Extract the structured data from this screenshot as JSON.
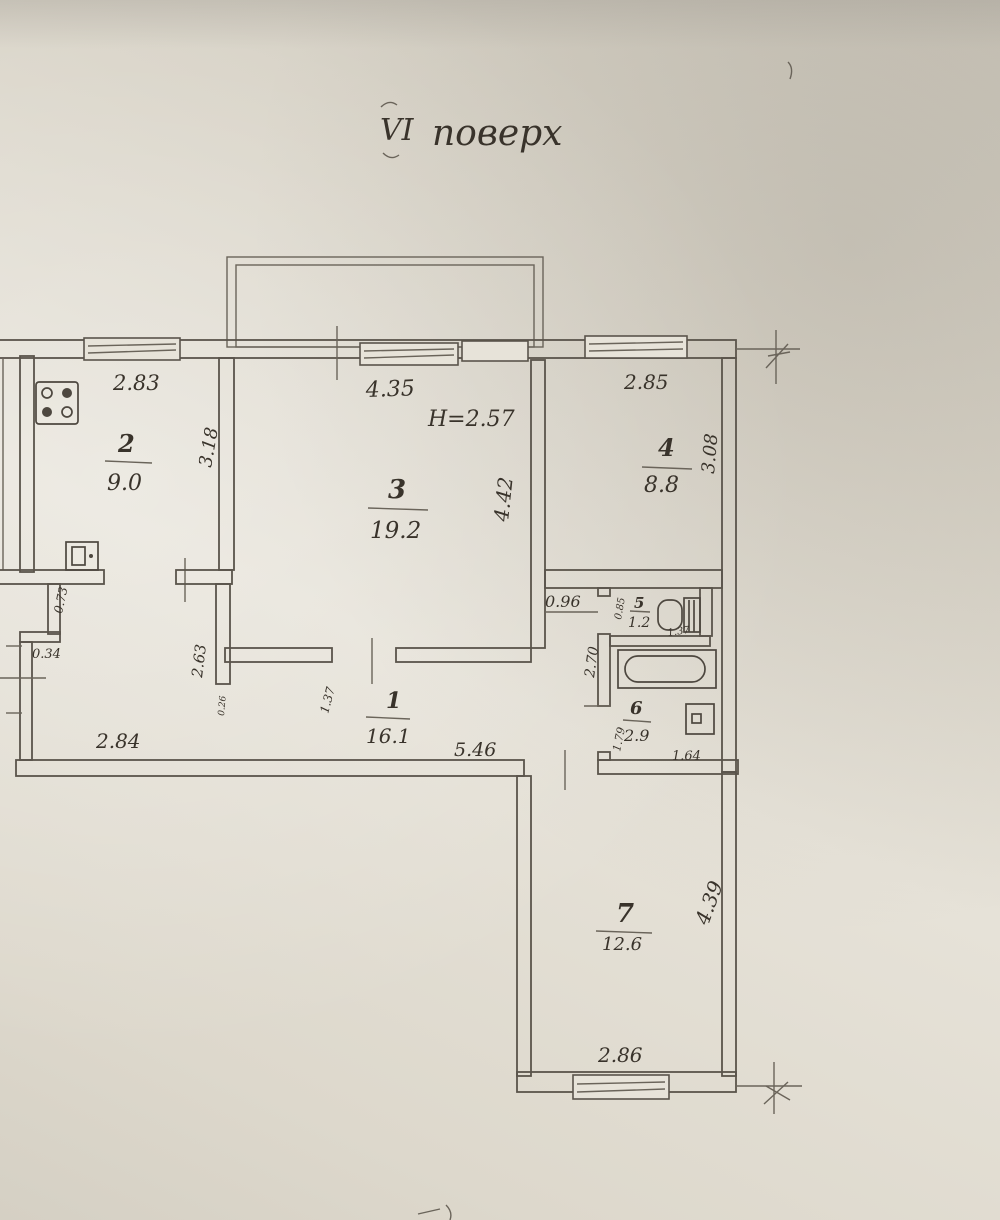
{
  "document": {
    "type": "apartment floor plan (hand-drawn BTI sketch)",
    "floor_title": {
      "roman": "VI",
      "word": "поверх"
    },
    "ceiling_height_note": "H=2.57"
  },
  "rooms": {
    "r1": {
      "number": "1",
      "area": "16.1"
    },
    "r2": {
      "number": "2",
      "area": "9.0"
    },
    "r3": {
      "number": "3",
      "area": "19.2"
    },
    "r4": {
      "number": "4",
      "area": "8.8"
    },
    "r5": {
      "number": "5",
      "area": "1.2"
    },
    "r6": {
      "number": "6",
      "area": "2.9"
    },
    "r7": {
      "number": "7",
      "area": "12.6"
    }
  },
  "dims": {
    "r2_width": "2.83",
    "r2_depth": "3.18",
    "r3_width": "4.35",
    "r3_depth": "4.42",
    "r4_width": "2.85",
    "r4_depth": "3.08",
    "niche_width": "0.96",
    "r5_width": "0.85",
    "r5_depth": "1.37",
    "r6_outer_depth": "2.70",
    "r6_inner_depth": "1.79",
    "r6_width": "1.64",
    "r1_pass_width": "1.37",
    "r1_length": "5.46",
    "alcove_niche_depth": "0.73",
    "alcove_step": "0.34",
    "alcove_width": "2.84",
    "alcove_depth": "2.63",
    "wall_thickness": "0.26",
    "r7_depth": "4.39",
    "r7_width": "2.86"
  },
  "icons": {
    "stove": "stove",
    "kitchen_sink": "kitchen sink",
    "toilet": "toilet",
    "bathtub": "bathtub",
    "washbasin": "washbasin"
  },
  "colors": {
    "paper": "#e0dbd0",
    "ink": "#5a544b",
    "pencil": "#39332b"
  }
}
